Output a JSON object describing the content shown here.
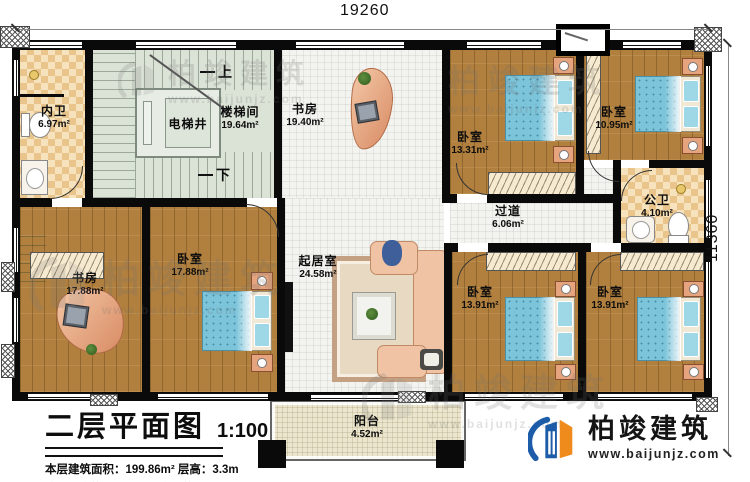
{
  "dims": {
    "width": "19260",
    "height": "11360"
  },
  "stairs": {
    "up": "上",
    "down": "下",
    "shaft": "电梯井"
  },
  "rooms": {
    "neiwei": {
      "label": "内卫",
      "area": "6.97m²"
    },
    "loutijian": {
      "label": "楼梯间",
      "area": "19.64m²"
    },
    "shufang_top": {
      "label": "书房",
      "area": "19.40m²"
    },
    "woshi_a": {
      "label": "卧室",
      "area": "13.31m²"
    },
    "woshi_b": {
      "label": "卧室",
      "area": "10.95m²"
    },
    "gongwei": {
      "label": "公卫",
      "area": "4.10m²"
    },
    "guodao": {
      "label": "过道",
      "area": "6.06m²"
    },
    "shufang_b": {
      "label": "书房",
      "area": "17.88m²"
    },
    "woshi_c": {
      "label": "卧室",
      "area": "17.88m²"
    },
    "qijushi": {
      "label": "起居室",
      "area": "24.58m²"
    },
    "woshi_d": {
      "label": "卧室",
      "area": "13.91m²"
    },
    "woshi_e": {
      "label": "卧室",
      "area": "13.91m²"
    },
    "yangtai": {
      "label": "阳台",
      "area": "4.52m²"
    }
  },
  "title_block": {
    "title": "二层平面图",
    "scale": "1:100",
    "info": "本层建筑面积：199.86m²  层高：3.3m",
    "note": "注：阳台算半面积，露台不算面积"
  },
  "brand": {
    "name": "柏竣建筑",
    "url": "www.baijunjz.com"
  },
  "watermark": {
    "name": "柏竣建筑",
    "url": "www.baijunjz.com"
  },
  "colors": {
    "accent_blue": "#1c5ca8",
    "accent_orange": "#ef8b1c",
    "wall": "#0a0a0a"
  }
}
